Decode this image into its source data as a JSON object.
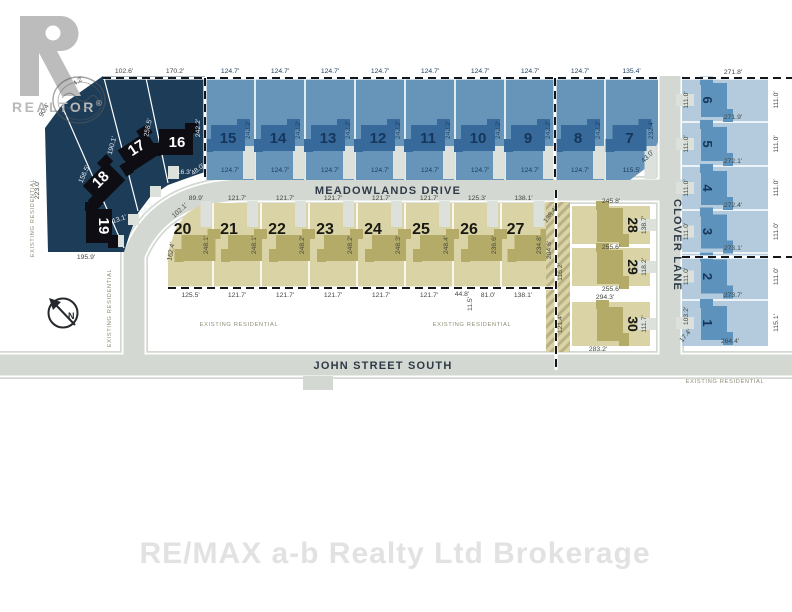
{
  "watermark": "RE/MAX a-b Realty Ltd Brokerage",
  "logo": {
    "text": "REALTOR",
    "reg": "®"
  },
  "compass": {
    "label": "N"
  },
  "streets": {
    "meadowlands": "MEADOWLANDS DRIVE",
    "john": "JOHN STREET SOUTH",
    "clover": "CLOVER LANE"
  },
  "area_label": "EXISTING RESIDENTIAL",
  "colors": {
    "lot_dark_navy": "#1d3c58",
    "lot_blue": "#6795ba",
    "lot_blue_light": "#b3cbdc",
    "lot_tan": "#d9d3a5",
    "house_blue": "#38699b",
    "house_blue_light": "#5d92bd",
    "house_olive": "#b5ab68",
    "house_black": "#0d0d13",
    "road": "#d4d8d2",
    "hatch": "#b9b083",
    "meas_dark": "#44483f",
    "meas_navy": "#1b3c5c",
    "meas_white": "#e8edf2"
  },
  "top_row": [
    {
      "num": "15",
      "top": "124.7'",
      "bottom": "124.7'",
      "side": "242.2'"
    },
    {
      "num": "14",
      "top": "124.7'",
      "bottom": "124.7'",
      "side": "242.2'"
    },
    {
      "num": "13",
      "top": "124.7'",
      "bottom": "124.7'",
      "side": "242.2'"
    },
    {
      "num": "12",
      "top": "124.7'",
      "bottom": "124.7'",
      "side": "242.2'"
    },
    {
      "num": "11",
      "top": "124.7'",
      "bottom": "124.7'",
      "side": "242.2'"
    },
    {
      "num": "10",
      "top": "124.7'",
      "bottom": "124.7'",
      "side": "242.2'"
    },
    {
      "num": "9",
      "top": "124.7'",
      "bottom": "124.7'",
      "side": "242.2'"
    },
    {
      "num": "8",
      "top": "124.7'",
      "bottom": "124.7'",
      "side": "242.2'"
    },
    {
      "num": "7",
      "top": "135.4'",
      "bottom": "115.5'",
      "side": "232.4'",
      "corner": "43.0'"
    }
  ],
  "dark_block": {
    "lots": [
      "16",
      "17",
      "18",
      "19"
    ],
    "labels": {
      "top1": "102.6'",
      "top2": "170.2'",
      "edge_ul": "124.2'",
      "edge_l": "90.4'",
      "left": "223.0'",
      "bottom": "195.9'",
      "diag1": "258.5'",
      "diag2": "190.1'",
      "diag3": "156.5'",
      "side16": "242.2'",
      "c1": "16.3'",
      "c2": "48.0'",
      "c3": "13.1'",
      "c4": "96.3'"
    }
  },
  "mid_row": [
    {
      "num": "20",
      "top": "89.9'",
      "top2": "102.1'",
      "left": "162.4'",
      "side": "248.1'",
      "bottom": "125.5'"
    },
    {
      "num": "21",
      "top": "121.7'",
      "bottom": "121.7'",
      "side": "248.1'"
    },
    {
      "num": "22",
      "top": "121.7'",
      "bottom": "121.7'",
      "side": "248.2'"
    },
    {
      "num": "23",
      "top": "121.7'",
      "bottom": "121.7'",
      "side": "248.2'"
    },
    {
      "num": "24",
      "top": "121.7'",
      "bottom": "121.7'",
      "side": "248.3'"
    },
    {
      "num": "25",
      "top": "121.7'",
      "bottom": "121.7'",
      "side": "248.4'"
    },
    {
      "num": "26",
      "top": "125.3'",
      "bottom": "44.8'",
      "bottom2": "81.0'",
      "bottom3": "11.5'",
      "side": "236.6'"
    },
    {
      "num": "27",
      "top": "138.1'",
      "bottom": "138.1'",
      "side": "234.8'"
    }
  ],
  "east_lots": [
    {
      "num": "28",
      "top": "245.8'",
      "bottom": "255.6'",
      "side": "138.7'"
    },
    {
      "num": "29",
      "bottom": "255.6'",
      "side": "118.2'"
    },
    {
      "num": "30",
      "top": "294.3'",
      "bottom": "283.2'",
      "side": "111.7'"
    }
  ],
  "right_col": [
    {
      "num": "6",
      "top": "271.8'",
      "bottom": "271.9'",
      "left": "111.0'",
      "right": "111.0'"
    },
    {
      "num": "5",
      "bottom": "272.1'",
      "left": "111.0'",
      "right": "111.0'"
    },
    {
      "num": "4",
      "bottom": "272.4'",
      "left": "111.0'",
      "right": "111.0'"
    },
    {
      "num": "3",
      "bottom": "273.1'",
      "left": "111.0'",
      "right": "111.0'"
    },
    {
      "num": "2",
      "bottom": "273.7'",
      "left": "111.0'",
      "right": "111.0'"
    },
    {
      "num": "1",
      "bottom": "264.4'",
      "left": "103.2'",
      "left2": "17.4'",
      "right": "115.1'"
    }
  ],
  "hatch_strip": {
    "labels": [
      "138.4'",
      "204.6'",
      "116.2'",
      "121.4'"
    ]
  }
}
